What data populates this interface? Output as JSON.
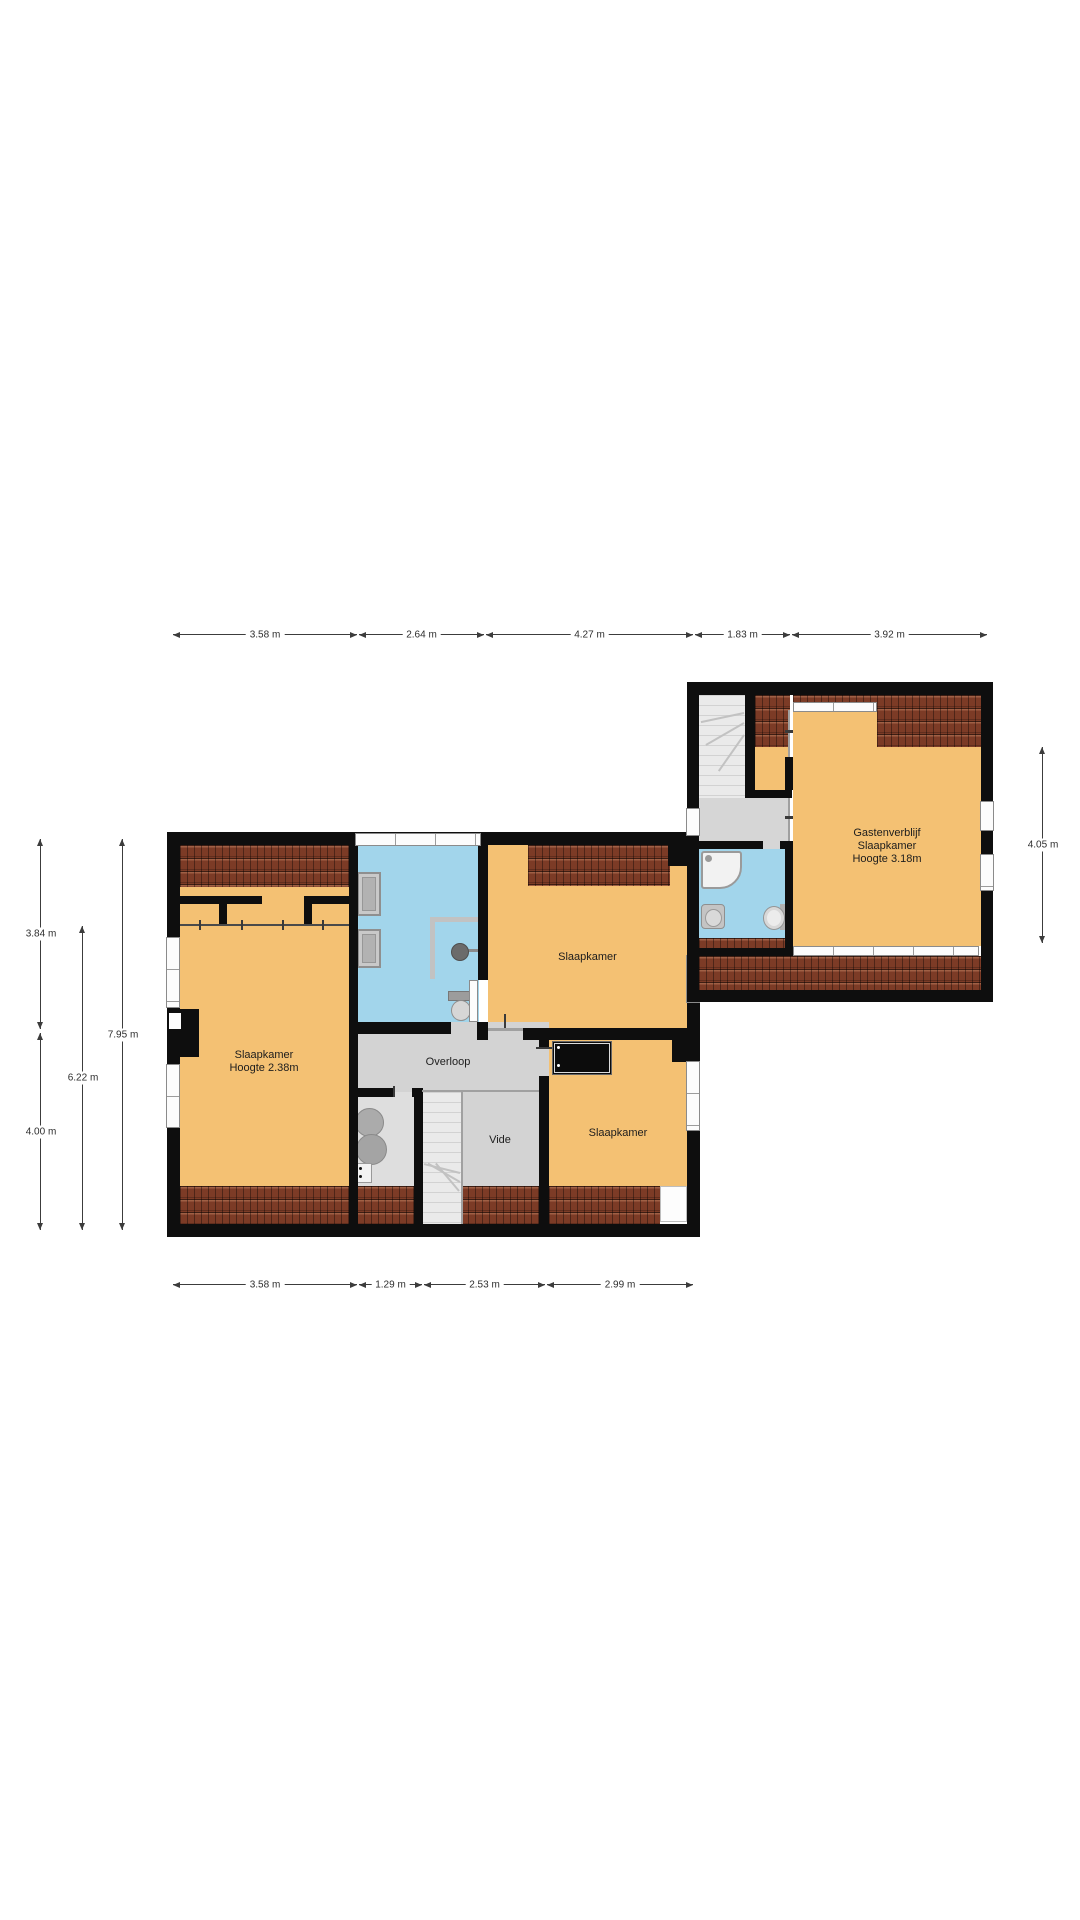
{
  "labels": {
    "room_left_1": "Slaapkamer",
    "room_left_2": "Hoogte 2.38m",
    "room_top": "Slaapkamer",
    "room_bottom": "Slaapkamer",
    "overloop": "Overloop",
    "vide": "Vide",
    "guest_1": "Gastenverblijf",
    "guest_2": "Slaapkamer",
    "guest_3": "Hoogte 3.18m"
  },
  "dimensions": {
    "top": [
      {
        "label": "3.58 m"
      },
      {
        "label": "2.64 m"
      },
      {
        "label": "4.27 m"
      },
      {
        "label": "1.83 m"
      },
      {
        "label": "3.92 m"
      }
    ],
    "bottom": [
      {
        "label": "3.58 m"
      },
      {
        "label": "1.29 m"
      },
      {
        "label": "2.53 m"
      },
      {
        "label": "2.99 m"
      }
    ],
    "left": [
      {
        "label": "3.84 m"
      },
      {
        "label": "4.00 m"
      },
      {
        "label": "6.22 m"
      },
      {
        "label": "7.95 m"
      }
    ],
    "right": [
      {
        "label": "4.05 m"
      }
    ]
  },
  "colors": {
    "wall": "#0e0e0e",
    "room_floor": "#f4c173",
    "bathroom_floor": "#a2d5eb",
    "hallway_floor": "#d3d3d3",
    "roof_tiles": "#7c3b26",
    "window": "#fcfcfc"
  },
  "furniture": [
    "stairs",
    "bathtub",
    "shower",
    "toilet",
    "sink",
    "radiator",
    "washing-machine",
    "tv",
    "wardrobe-rail"
  ]
}
